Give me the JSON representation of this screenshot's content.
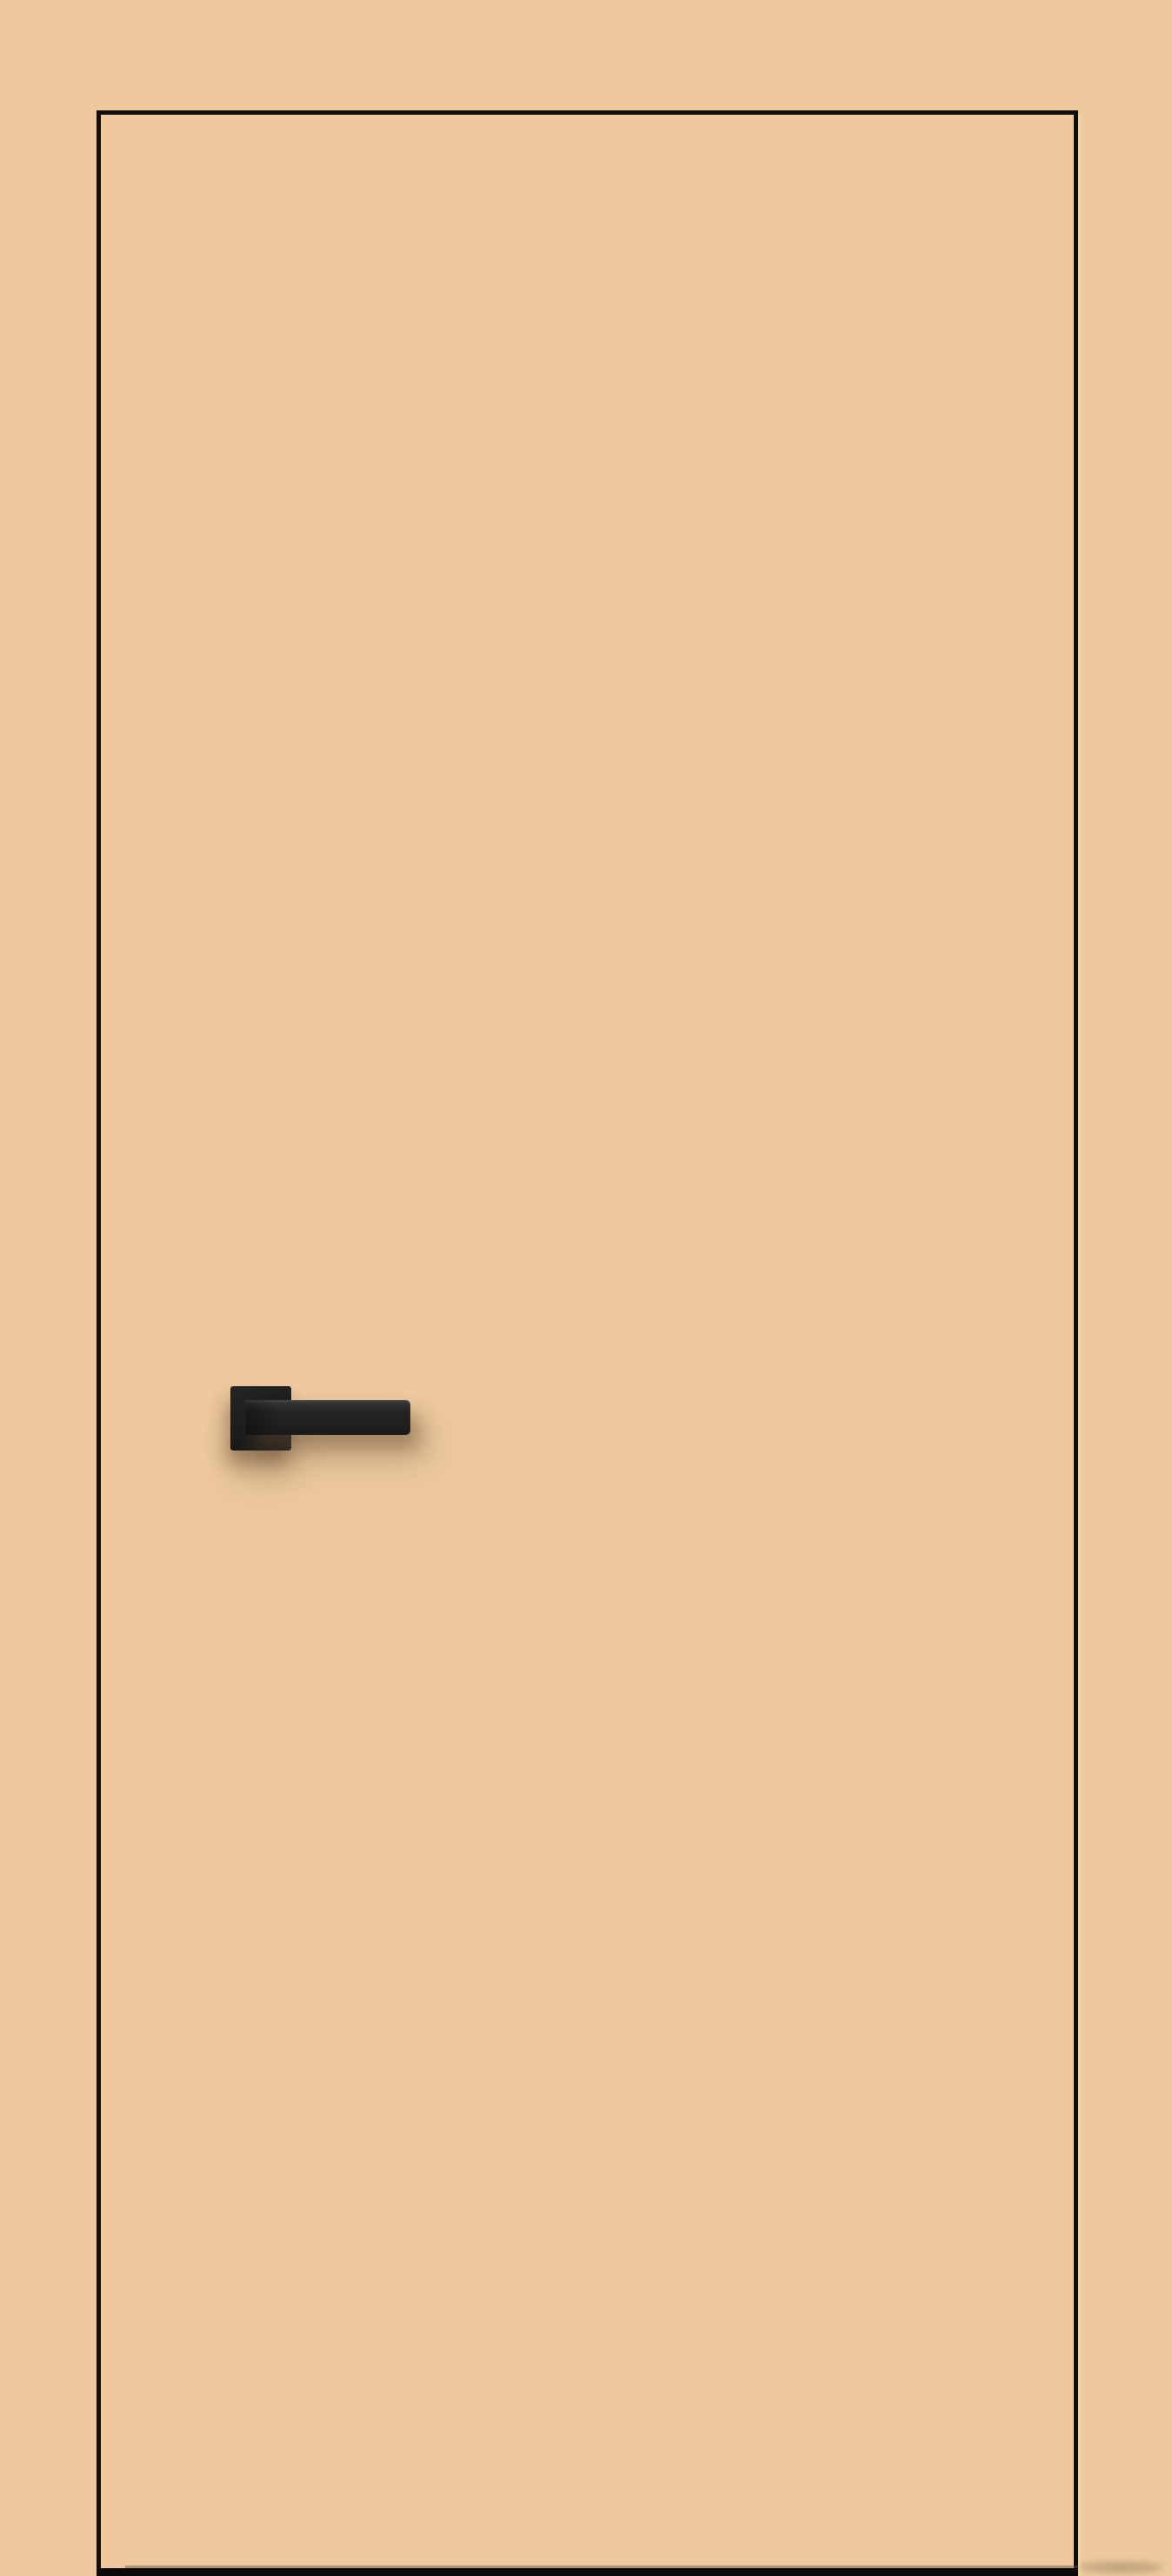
{
  "scene": {
    "type": "product-render",
    "subject": "flush interior door, beige finish matching the wall, thin black edge trim, black square-rosette lever handle on the left side",
    "objects": [
      "door-panel",
      "door-bottom-edge",
      "door-handle",
      "handle-rosette",
      "handle-lever"
    ]
  },
  "colors": {
    "background": "#edc99d",
    "door_fill": "#edc99d",
    "door_edge": "#0f0e0c",
    "door_bottom_edge": "#0b0a08",
    "edge_highlight": "#f6ddb4",
    "handle_dark": "#1b1b1b",
    "handle_mid": "#252525",
    "handle_highlight": "#3a3a3a",
    "shadow": "rgba(97, 74, 48, 0.45)",
    "shadow_soft": "rgba(97, 74, 48, 0.22)"
  }
}
